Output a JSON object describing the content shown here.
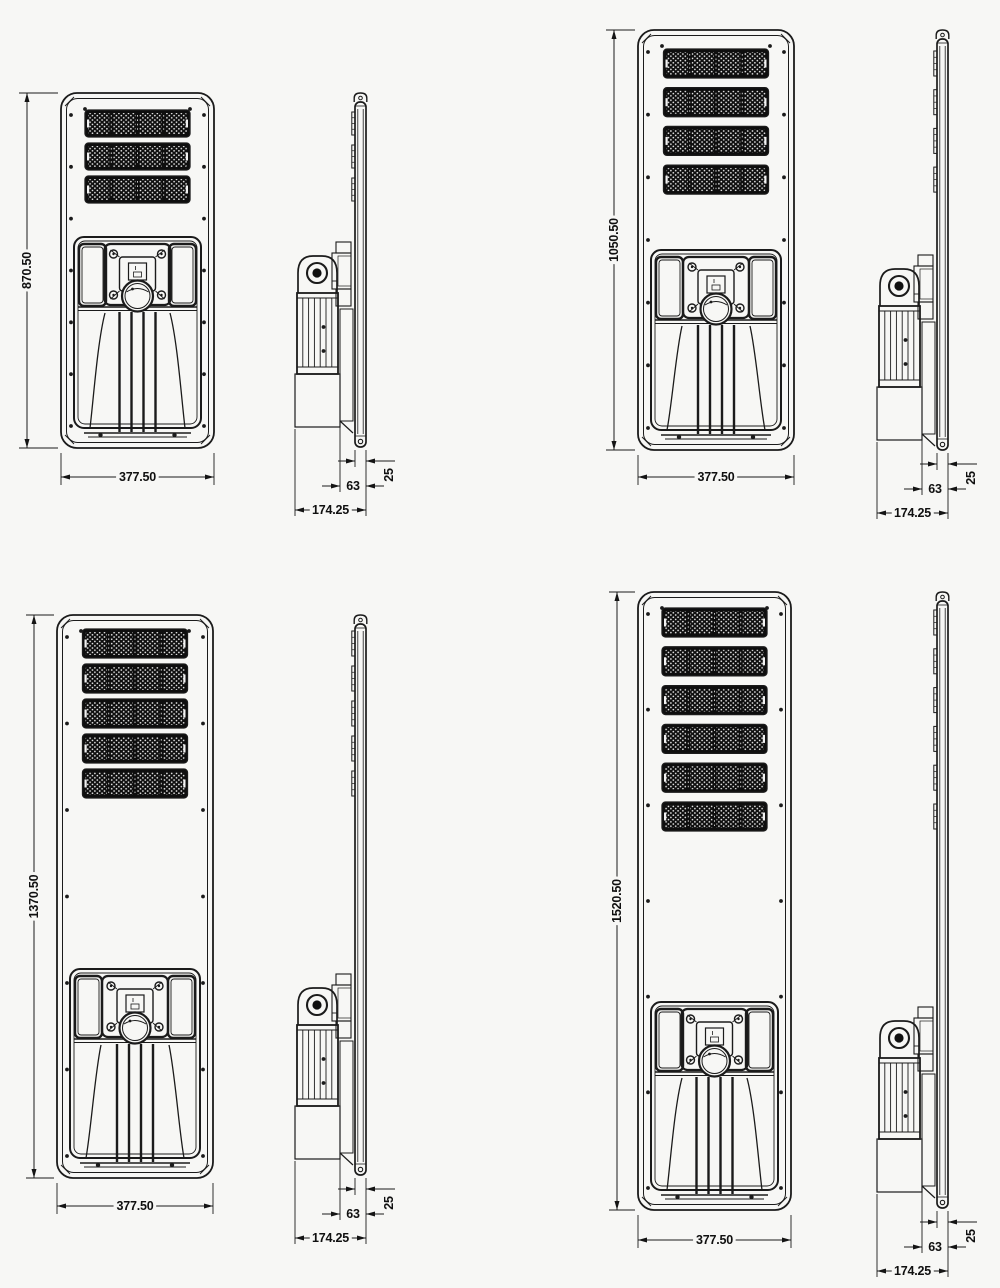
{
  "sheet": {
    "background": "#f7f7f5",
    "stroke_color": "#1b1b1b",
    "description": "all-in-one solar street light dimensional drawing, four sizes, front and side views"
  },
  "drawing": {
    "variants": [
      {
        "name": "streetlight-3-led-modules",
        "led_module_rows": 3,
        "dimensions": {
          "height": "870.50",
          "width": "377.50",
          "depth": "174.25",
          "mount_depth": "63",
          "panel_thickness": "25"
        }
      },
      {
        "name": "streetlight-4-led-modules",
        "led_module_rows": 4,
        "dimensions": {
          "height": "1050.50",
          "width": "377.50",
          "depth": "174.25",
          "mount_depth": "63",
          "panel_thickness": "25"
        }
      },
      {
        "name": "streetlight-5-led-modules",
        "led_module_rows": 5,
        "dimensions": {
          "height": "1370.50",
          "width": "377.50",
          "depth": "174.25",
          "mount_depth": "63",
          "panel_thickness": "25"
        }
      },
      {
        "name": "streetlight-6-led-modules",
        "led_module_rows": 6,
        "dimensions": {
          "height": "1520.50",
          "width": "377.50",
          "depth": "174.25",
          "mount_depth": "63",
          "panel_thickness": "25"
        }
      }
    ]
  }
}
